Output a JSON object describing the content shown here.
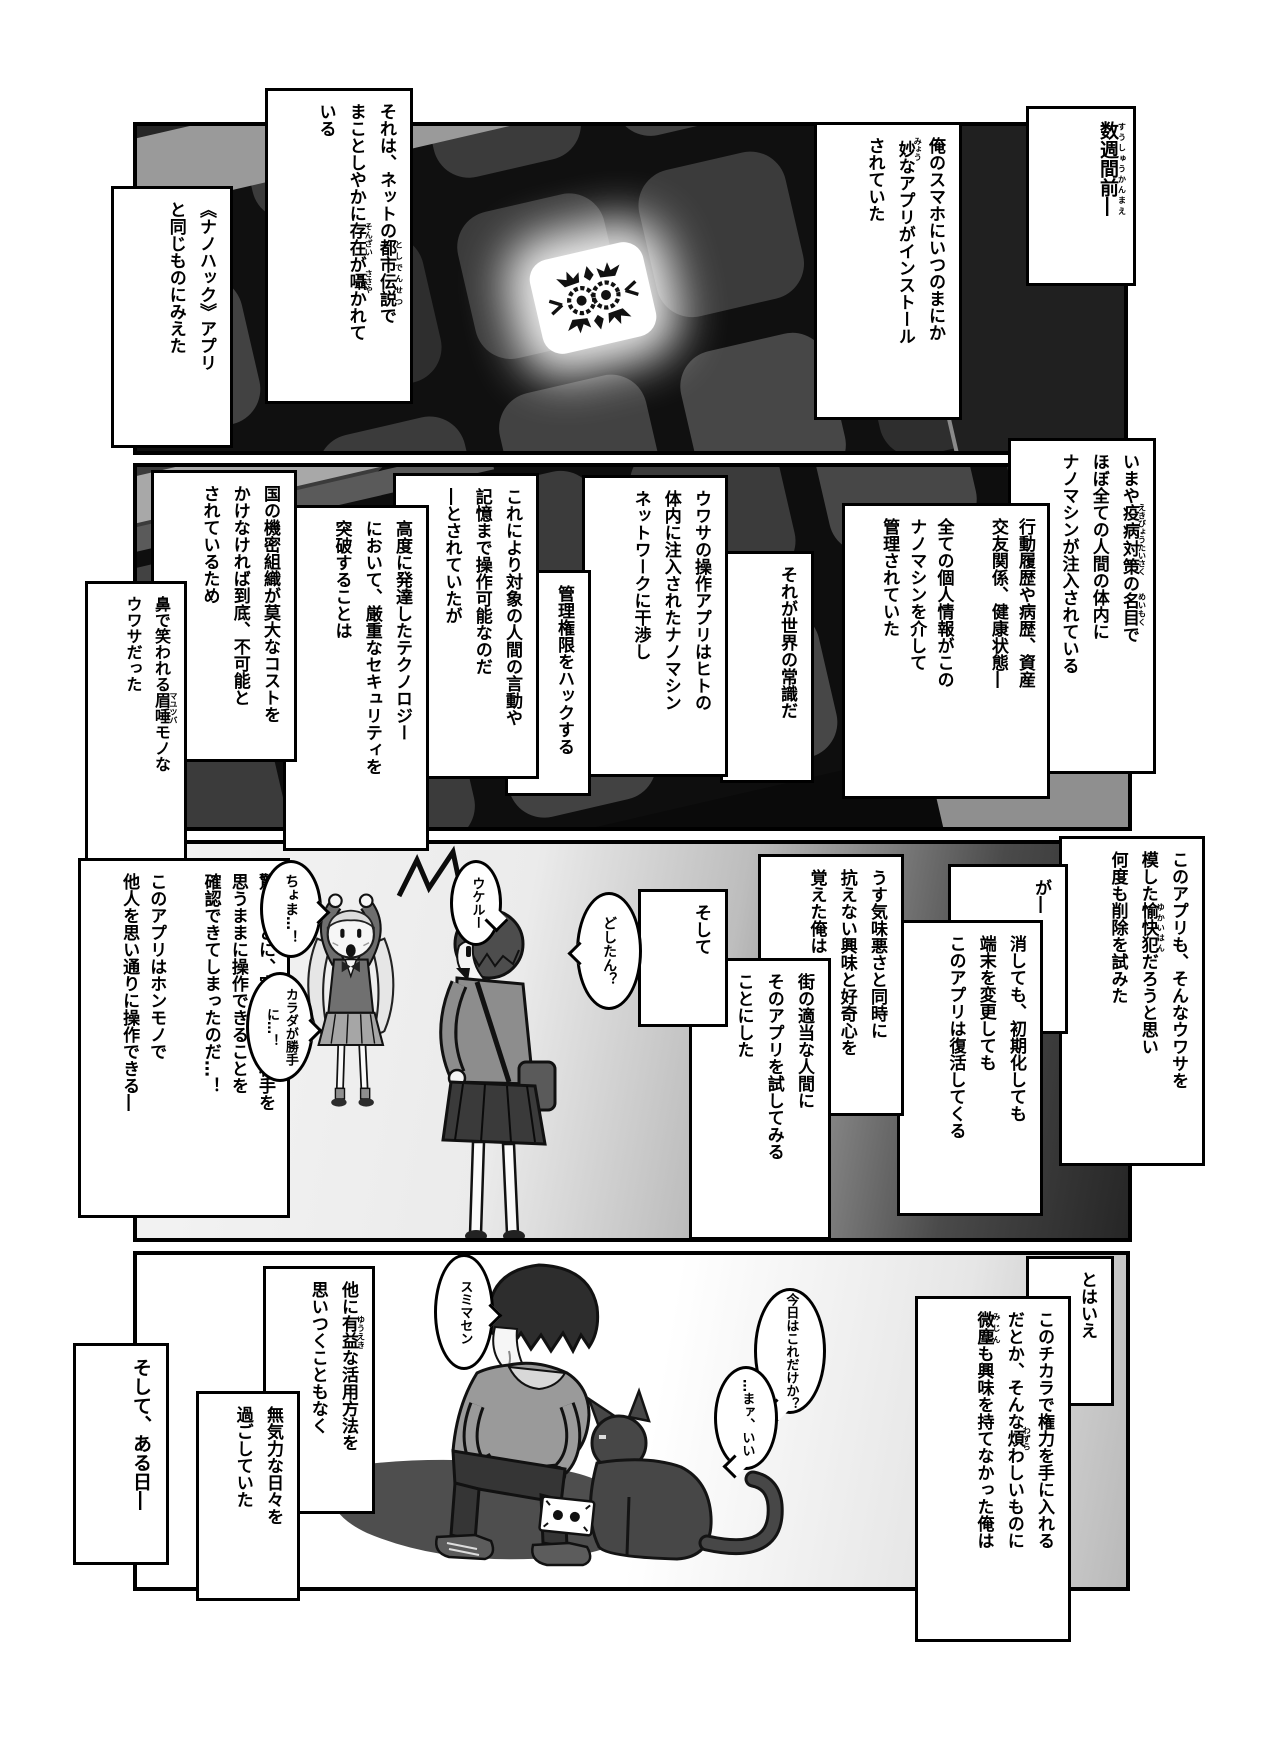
{
  "page_type": "manga-page",
  "p1": {
    "weeks": [
      [
        {
          "t": "数週間前―",
          "r": "すうしゅうかんまえ"
        }
      ]
    ],
    "phone": [
      [
        "俺のスマホにいつのまにか"
      ],
      [
        {
          "t": "妙",
          "r": "みょう"
        },
        "なアプリがインストール"
      ],
      [
        "されていた"
      ]
    ],
    "rumor": [
      [
        "それは、ネットの",
        {
          "t": "都市伝説",
          "r": "としでんせつ"
        },
        "で"
      ],
      [
        "まことしやかに",
        {
          "t": "存在",
          "r": "そんざい"
        },
        "が",
        {
          "t": "囁",
          "r": "ささや"
        },
        "かれて"
      ],
      [
        "いる"
      ]
    ],
    "nanohack": [
      [
        "《ナノハック》アプリ"
      ],
      [
        "と同じものにみえた"
      ]
    ]
  },
  "p2": {
    "vaccine": [
      [
        "いまや",
        {
          "t": "疫病対策",
          "r": "えきびょうたいさく"
        },
        "の",
        {
          "t": "名目",
          "r": "めいもく"
        },
        "で"
      ],
      [
        "ほぼ全ての人間の体内に"
      ],
      [
        "ナノマシンが注入されている"
      ]
    ],
    "personal": [
      [
        "行動履歴や病歴、資産"
      ],
      [
        "交友関係、健康状態―"
      ],
      [
        ""
      ],
      [
        "全ての個人情報がこの"
      ],
      [
        "ナノマシンを介して"
      ],
      [
        "管理されていた"
      ]
    ],
    "common": [
      [
        "それが世界の常識だ"
      ]
    ],
    "appdesc": [
      [
        "ウワサの操作アプリはヒトの"
      ],
      [
        "体内に注入されたナノマシン"
      ],
      [
        "ネットワークに干渉し"
      ]
    ],
    "hack": [
      [
        "管理権限をハックする"
      ]
    ],
    "control": [
      [
        "これにより対象の人間の言動や"
      ],
      [
        "記憶まで操作可能なのだ"
      ],
      [
        "―とされていたが"
      ]
    ],
    "security": [
      [
        "高度に発達したテクノロジー"
      ],
      [
        "において、厳重なセキュリティを"
      ],
      [
        "突破することは"
      ]
    ],
    "cost": [
      [
        "国の機密組織が莫大なコストを"
      ],
      [
        "かけなければ到底、不可能と"
      ],
      [
        "されているため"
      ]
    ],
    "laugh": [
      [
        "鼻で笑われる",
        {
          "t": "眉唾",
          "r": "マユツバ"
        },
        "モノな"
      ],
      [
        "ウワサだった"
      ]
    ]
  },
  "p3": {
    "delete": [
      [
        "このアプリも、そんなウワサを"
      ],
      [
        "模した",
        {
          "t": "愉快犯",
          "r": "ゆかいはん"
        },
        "だろうと思い"
      ],
      [
        "何度も削除を試みた"
      ]
    ],
    "ga": [
      [
        "が―"
      ]
    ],
    "revive": [
      [
        "消しても、初期化しても"
      ],
      [
        "端末を変更しても"
      ],
      [
        "このアプリは復活してくる"
      ]
    ],
    "curiosity": [
      [
        "うす気味悪さと同時に"
      ],
      [
        "抗えない興味と好奇心を"
      ],
      [
        "覚えた俺は"
      ]
    ],
    "try": [
      [
        "街の適当な人間に"
      ],
      [
        "そのアプリを試してみる"
      ],
      [
        "ことにした"
      ]
    ],
    "soshite": [
      [
        "そして"
      ]
    ],
    "surprised": [
      [
        "驚くことに、実際にその相手を"
      ],
      [
        "思うままに操作できることを"
      ],
      [
        "確認できてしまったのだ…！"
      ],
      [
        ""
      ],
      [
        "このアプリはホンモノで"
      ],
      [
        "他人を思い通りに操作できる―"
      ]
    ],
    "bub_dositan": [
      [
        "どしたん？"
      ]
    ],
    "bub_ukeru": [
      [
        "ウケルー"
      ]
    ],
    "bub_choma": [
      [
        "ちょま…！"
      ]
    ],
    "bub_karada": [
      [
        "カラダが",
        "勝手に…！"
      ]
    ]
  },
  "p4": {
    "tohaie": [
      [
        "とはいえ"
      ]
    ],
    "power": [
      [
        "このチカラで権力を手に入れる"
      ],
      [
        "だとか、そんな",
        {
          "t": "煩",
          "r": "わずら"
        },
        "わしいものに"
      ],
      [
        {
          "t": "微塵",
          "r": "みじん"
        },
        "も興味を持てなかった俺は"
      ]
    ],
    "useful": [
      [
        "他に",
        {
          "t": "有益",
          "r": "ゆうえき"
        },
        "な活用方法を"
      ],
      [
        "思いつくこともなく"
      ]
    ],
    "listless": [
      [
        "無気力な日々を"
      ],
      [
        "過ごしていた"
      ]
    ],
    "oneday": [
      [
        "そして、ある日―"
      ]
    ],
    "bub_sumimasen": [
      [
        "スミマセン"
      ]
    ],
    "bub_today": [
      [
        "今日は",
        "これだけか？"
      ]
    ],
    "bub_maa": [
      [
        "…まァ、",
        "いい"
      ]
    ]
  },
  "colors": {
    "panel_bg_dark": "#101010",
    "app_icon": "#3b3b3b",
    "glow": "#ffffff",
    "shadow": "#4e4e4e"
  }
}
